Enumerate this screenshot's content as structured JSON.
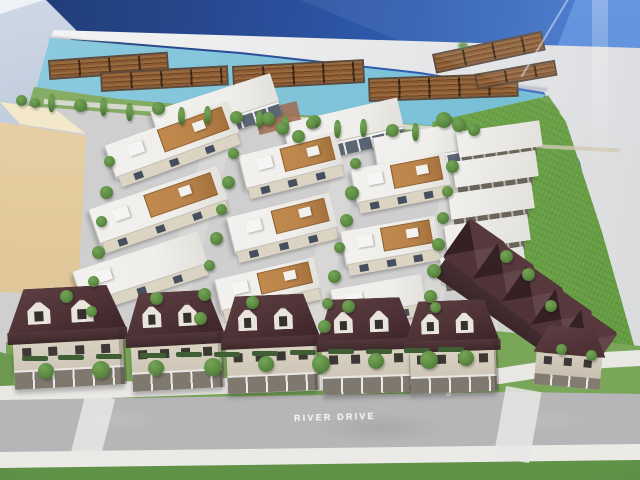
{
  "meta": {
    "type": "photograph",
    "subject": "Architectural scale model of a riverfront townhouse development displayed under glass in a presentation centre"
  },
  "labels": {
    "road": "RIVER DRIVE"
  },
  "scene": {
    "water_feature": "river with floating log booms",
    "building_groups": [
      "modern flat-roof townhouse rows with rooftop wood decks",
      "heritage-style houses with dark hip roofs and dormers along River Drive",
      "dark-roofed apartment building beside vacant grass field",
      "tan massing block of neighbouring building"
    ]
  },
  "palette": {
    "backdrop_navy": "#203c74",
    "backdrop_blue": "#3d74cd",
    "water": "#7cc2d8",
    "log_wood": "#8a5a33",
    "log_frame": "#5e4a3a",
    "bank_green": "#79a25a",
    "field_green": "#6da348",
    "street_gray": "#d0cfd0",
    "road_gray": "#b6b5b7",
    "sidewalk": "#e9e8e5",
    "lawn_green": "#7aa659",
    "grass_strip": "#5f9147",
    "roof_white": "#efeeea",
    "facade_cream": "#dcd4c3",
    "facade_slate": "#5c6574",
    "window_dark": "#454f5f",
    "deck_wood": "#b9834b",
    "heritage_roof": "#4e3236",
    "heritage_body": "#d3cbbc",
    "tan_wall": "#d9bd8d",
    "tan_roof": "#f3e8ca",
    "tree_dark": "#41682f",
    "tree_mid": "#5c8a42",
    "tree_light": "#74a556"
  }
}
